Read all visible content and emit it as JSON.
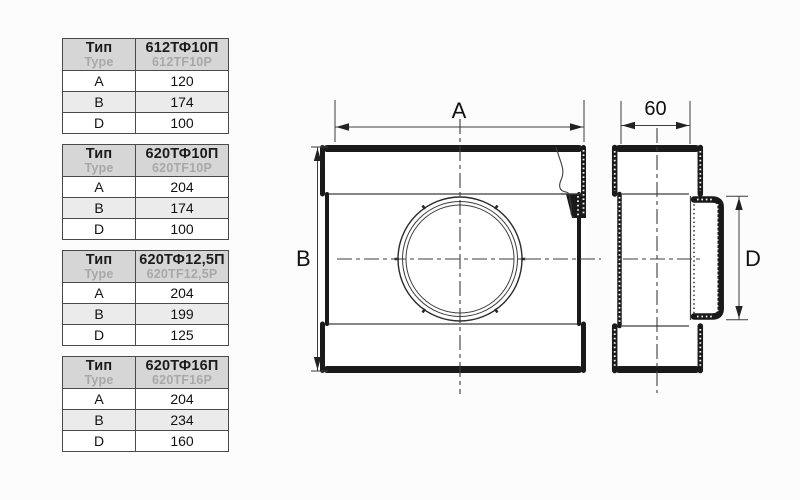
{
  "colors": {
    "background": "#fcfcfc",
    "table_border": "#4a4a4a",
    "table_header_bg": "#d6d6d6",
    "table_stripe_bg": "#ebebeb",
    "secondary_text_gray": "#a8a8a8",
    "drawing_line": "#1a1a1a"
  },
  "drawing": {
    "front_view": {
      "width_label": "A",
      "height_label": "B"
    },
    "side_view": {
      "depth_label": "60",
      "diameter_label": "D"
    }
  },
  "tables": [
    {
      "header_ru": "Тип",
      "header_en": "Type",
      "code_ru": "612ТФ10П",
      "code_en": "612TF10P",
      "rows": [
        {
          "param": "A",
          "value": "120"
        },
        {
          "param": "B",
          "value": "174"
        },
        {
          "param": "D",
          "value": "100"
        }
      ]
    },
    {
      "header_ru": "Тип",
      "header_en": "Type",
      "code_ru": "620ТФ10П",
      "code_en": "620TF10P",
      "rows": [
        {
          "param": "A",
          "value": "204"
        },
        {
          "param": "B",
          "value": "174"
        },
        {
          "param": "D",
          "value": "100"
        }
      ]
    },
    {
      "header_ru": "Тип",
      "header_en": "Type",
      "code_ru": "620ТФ12,5П",
      "code_en": "620TF12,5P",
      "rows": [
        {
          "param": "A",
          "value": "204"
        },
        {
          "param": "B",
          "value": "199"
        },
        {
          "param": "D",
          "value": "125"
        }
      ]
    },
    {
      "header_ru": "Тип",
      "header_en": "Type",
      "code_ru": "620ТФ16П",
      "code_en": "620TF16P",
      "rows": [
        {
          "param": "A",
          "value": "204"
        },
        {
          "param": "B",
          "value": "234"
        },
        {
          "param": "D",
          "value": "160"
        }
      ]
    }
  ]
}
